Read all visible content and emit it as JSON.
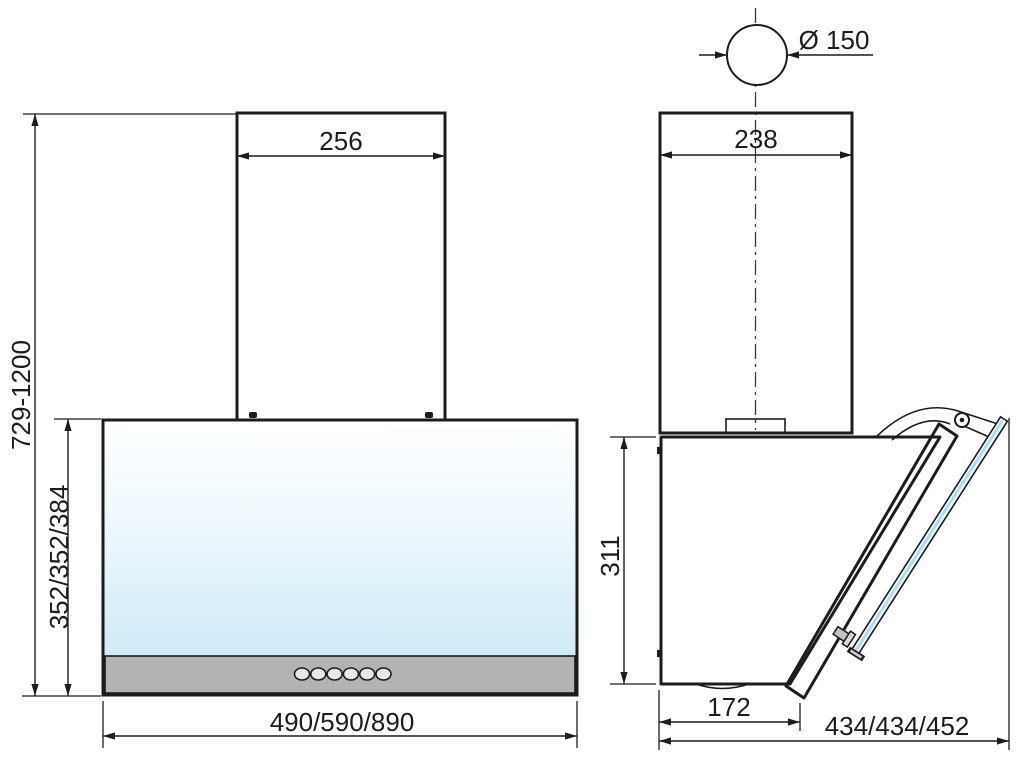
{
  "drawing": {
    "description": "Kitchen cooker hood installation drawing, front view and side view with dimensions in mm",
    "front_view": {
      "chimney_width_label": "256",
      "overall_height_label": "729-1200",
      "body_height_label": "352/352/384",
      "body_width_label": "490/590/890",
      "control_buttons_count": "6"
    },
    "side_view": {
      "duct_diameter_label": "Ø 150",
      "chimney_depth_label": "238",
      "body_height_label": "311",
      "bottom_depth_label": "172",
      "overall_depth_label": "434/434/452"
    },
    "colors": {
      "line": "#1c1c1c",
      "metal_light": "#f6f6f6",
      "metal_dark": "#a9a9a9",
      "glass_top": "#ffffff",
      "glass_blue": "#c7e7f7",
      "glass_edge_blue": "#a8dcef",
      "panel_gray": "#b3b3b3",
      "strip_gray": "#c2c2c2",
      "button_face": "#e8e8e8"
    }
  }
}
